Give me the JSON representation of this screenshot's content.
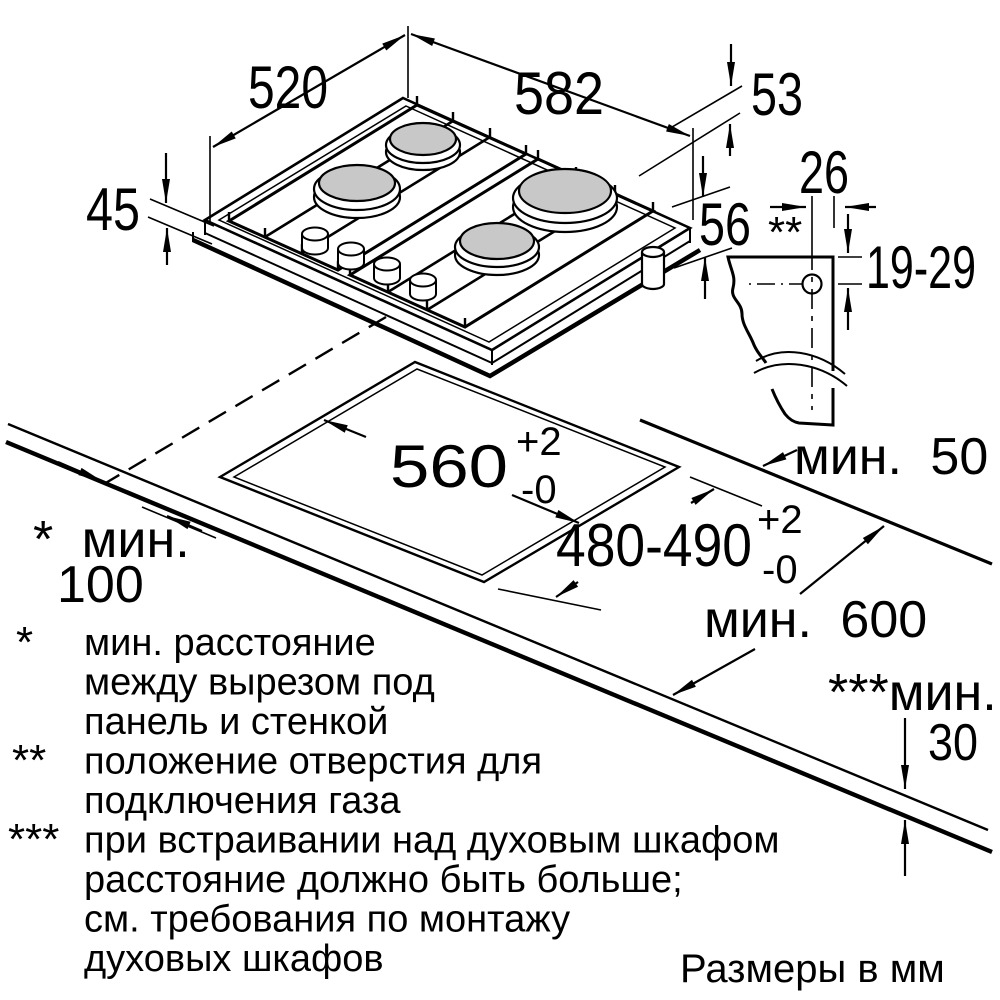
{
  "dims": {
    "d520": "520",
    "d582": "582",
    "d53": "53",
    "d45": "45",
    "d56": "56",
    "d26": "26",
    "d19_29": "19-29",
    "gas_marker": "**"
  },
  "cutout": {
    "width": "560",
    "width_sup": "+2",
    "width_sub": "-0",
    "depth": "480-490",
    "depth_sup": "+2",
    "depth_sub": "-0"
  },
  "clearances": {
    "back": "мин. 50",
    "side_label": "* мин.",
    "side_value": "100",
    "front_depth": "мин. 600",
    "thickness_label": "***мин.",
    "thickness_value": "30"
  },
  "footnotes": [
    {
      "marker": "*",
      "lines": [
        "мин. расстояние",
        "между вырезом под",
        "панель и стенкой"
      ]
    },
    {
      "marker": "**",
      "lines": [
        "положение отверстия для",
        "подключения газа"
      ]
    },
    {
      "marker": "***",
      "lines": [
        "при встраивании над духовым шкафом",
        "расстояние должно быть больше;",
        "см. требования по монтажу",
        "духовых шкафов"
      ]
    }
  ],
  "footer": {
    "units": "Размеры в мм"
  },
  "colors": {
    "line": "#000000",
    "burner": "#c8c8c8",
    "background": "#ffffff"
  }
}
